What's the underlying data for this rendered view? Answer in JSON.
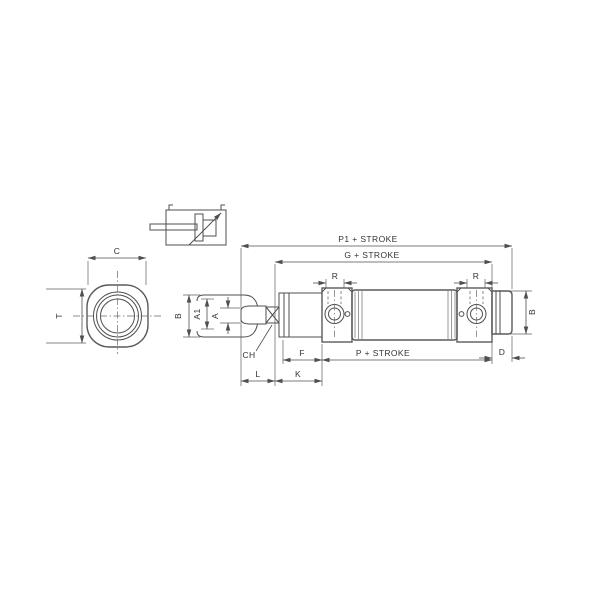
{
  "diagram": {
    "labels": {
      "c": "C",
      "t": "T",
      "b_front": "B",
      "a1": "A1",
      "a": "A",
      "ch": "CH",
      "l": "L",
      "k": "K",
      "f": "F",
      "d": "D",
      "b_rear": "B",
      "r_left": "R",
      "r_right": "R",
      "p1_stroke": "P1 + STROKE",
      "g_stroke": "G + STROKE",
      "p_stroke": "P + STROKE"
    },
    "colors": {
      "background": "#ffffff",
      "line": "#4f4f4f",
      "text": "#333333",
      "shading": "#9a9a9a"
    }
  }
}
